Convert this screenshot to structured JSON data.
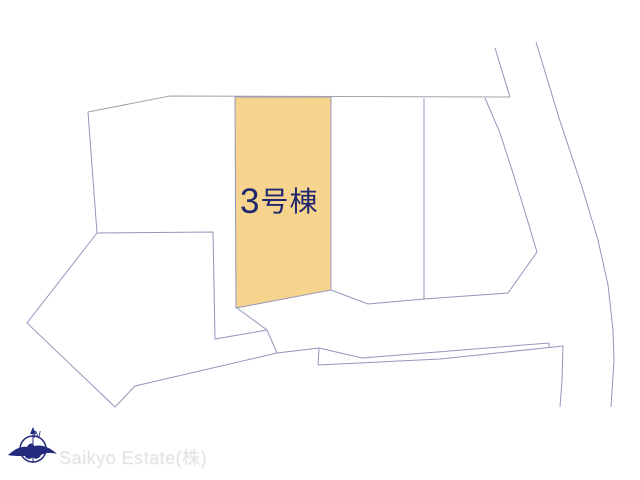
{
  "plan": {
    "background_color": "#ffffff",
    "line_color": "#9595bd",
    "boundary_line_color": "#a2a2ae",
    "highlight": {
      "label": "3号棟",
      "label_number": "3",
      "label_suffix": "号棟",
      "label_color": "#20276e",
      "fill": "#f6d48d",
      "points": "235,97 331,97 331,290 236,308"
    },
    "lines": [
      {
        "name": "north-lot-top-edge",
        "points": "88,112 170,96 510,97",
        "color": "#a2a2ae"
      },
      {
        "name": "west-lot-left-edge",
        "points": "88,112 97,233"
      },
      {
        "name": "west-lot-bottom-and-inner-edge",
        "points": "97,233 213,232 215,339 267,330"
      },
      {
        "name": "parcel-divider-from-highlight-corner",
        "points": "237,308 267,330 277,353"
      },
      {
        "name": "southwest-pentagon-boundary",
        "points": "97,233 27,323 115,407 135,386 277,353 319,348"
      },
      {
        "name": "path-left-end-join",
        "points": "319,348 318,365"
      },
      {
        "name": "path-top-edge",
        "points": "319,348 362,358 549,343 549,347"
      },
      {
        "name": "path-bottom-edge-and-right-drop",
        "points": "318,365 440,359 563,346 562,380 560,407"
      },
      {
        "name": "center-lot-divider",
        "points": "424,98 424,299"
      },
      {
        "name": "center-lots-bottom-edge",
        "points": "331,290 368,304 424,299 508,293 537,252"
      },
      {
        "name": "road-left-edge",
        "points": "485,98 500,133 512,170 525,212 537,252"
      },
      {
        "name": "road-upper-left-edge",
        "points": "495,48 510,97"
      },
      {
        "name": "road-right-edge",
        "points": "536,42 559,118 582,187 598,240 608,285 613,330 614,360 611,407"
      }
    ]
  },
  "compass": {
    "letter": "N",
    "color": "#232a7c"
  },
  "watermark": {
    "text": "Saikyo Estate(株)",
    "color": "#e3e3e3"
  }
}
